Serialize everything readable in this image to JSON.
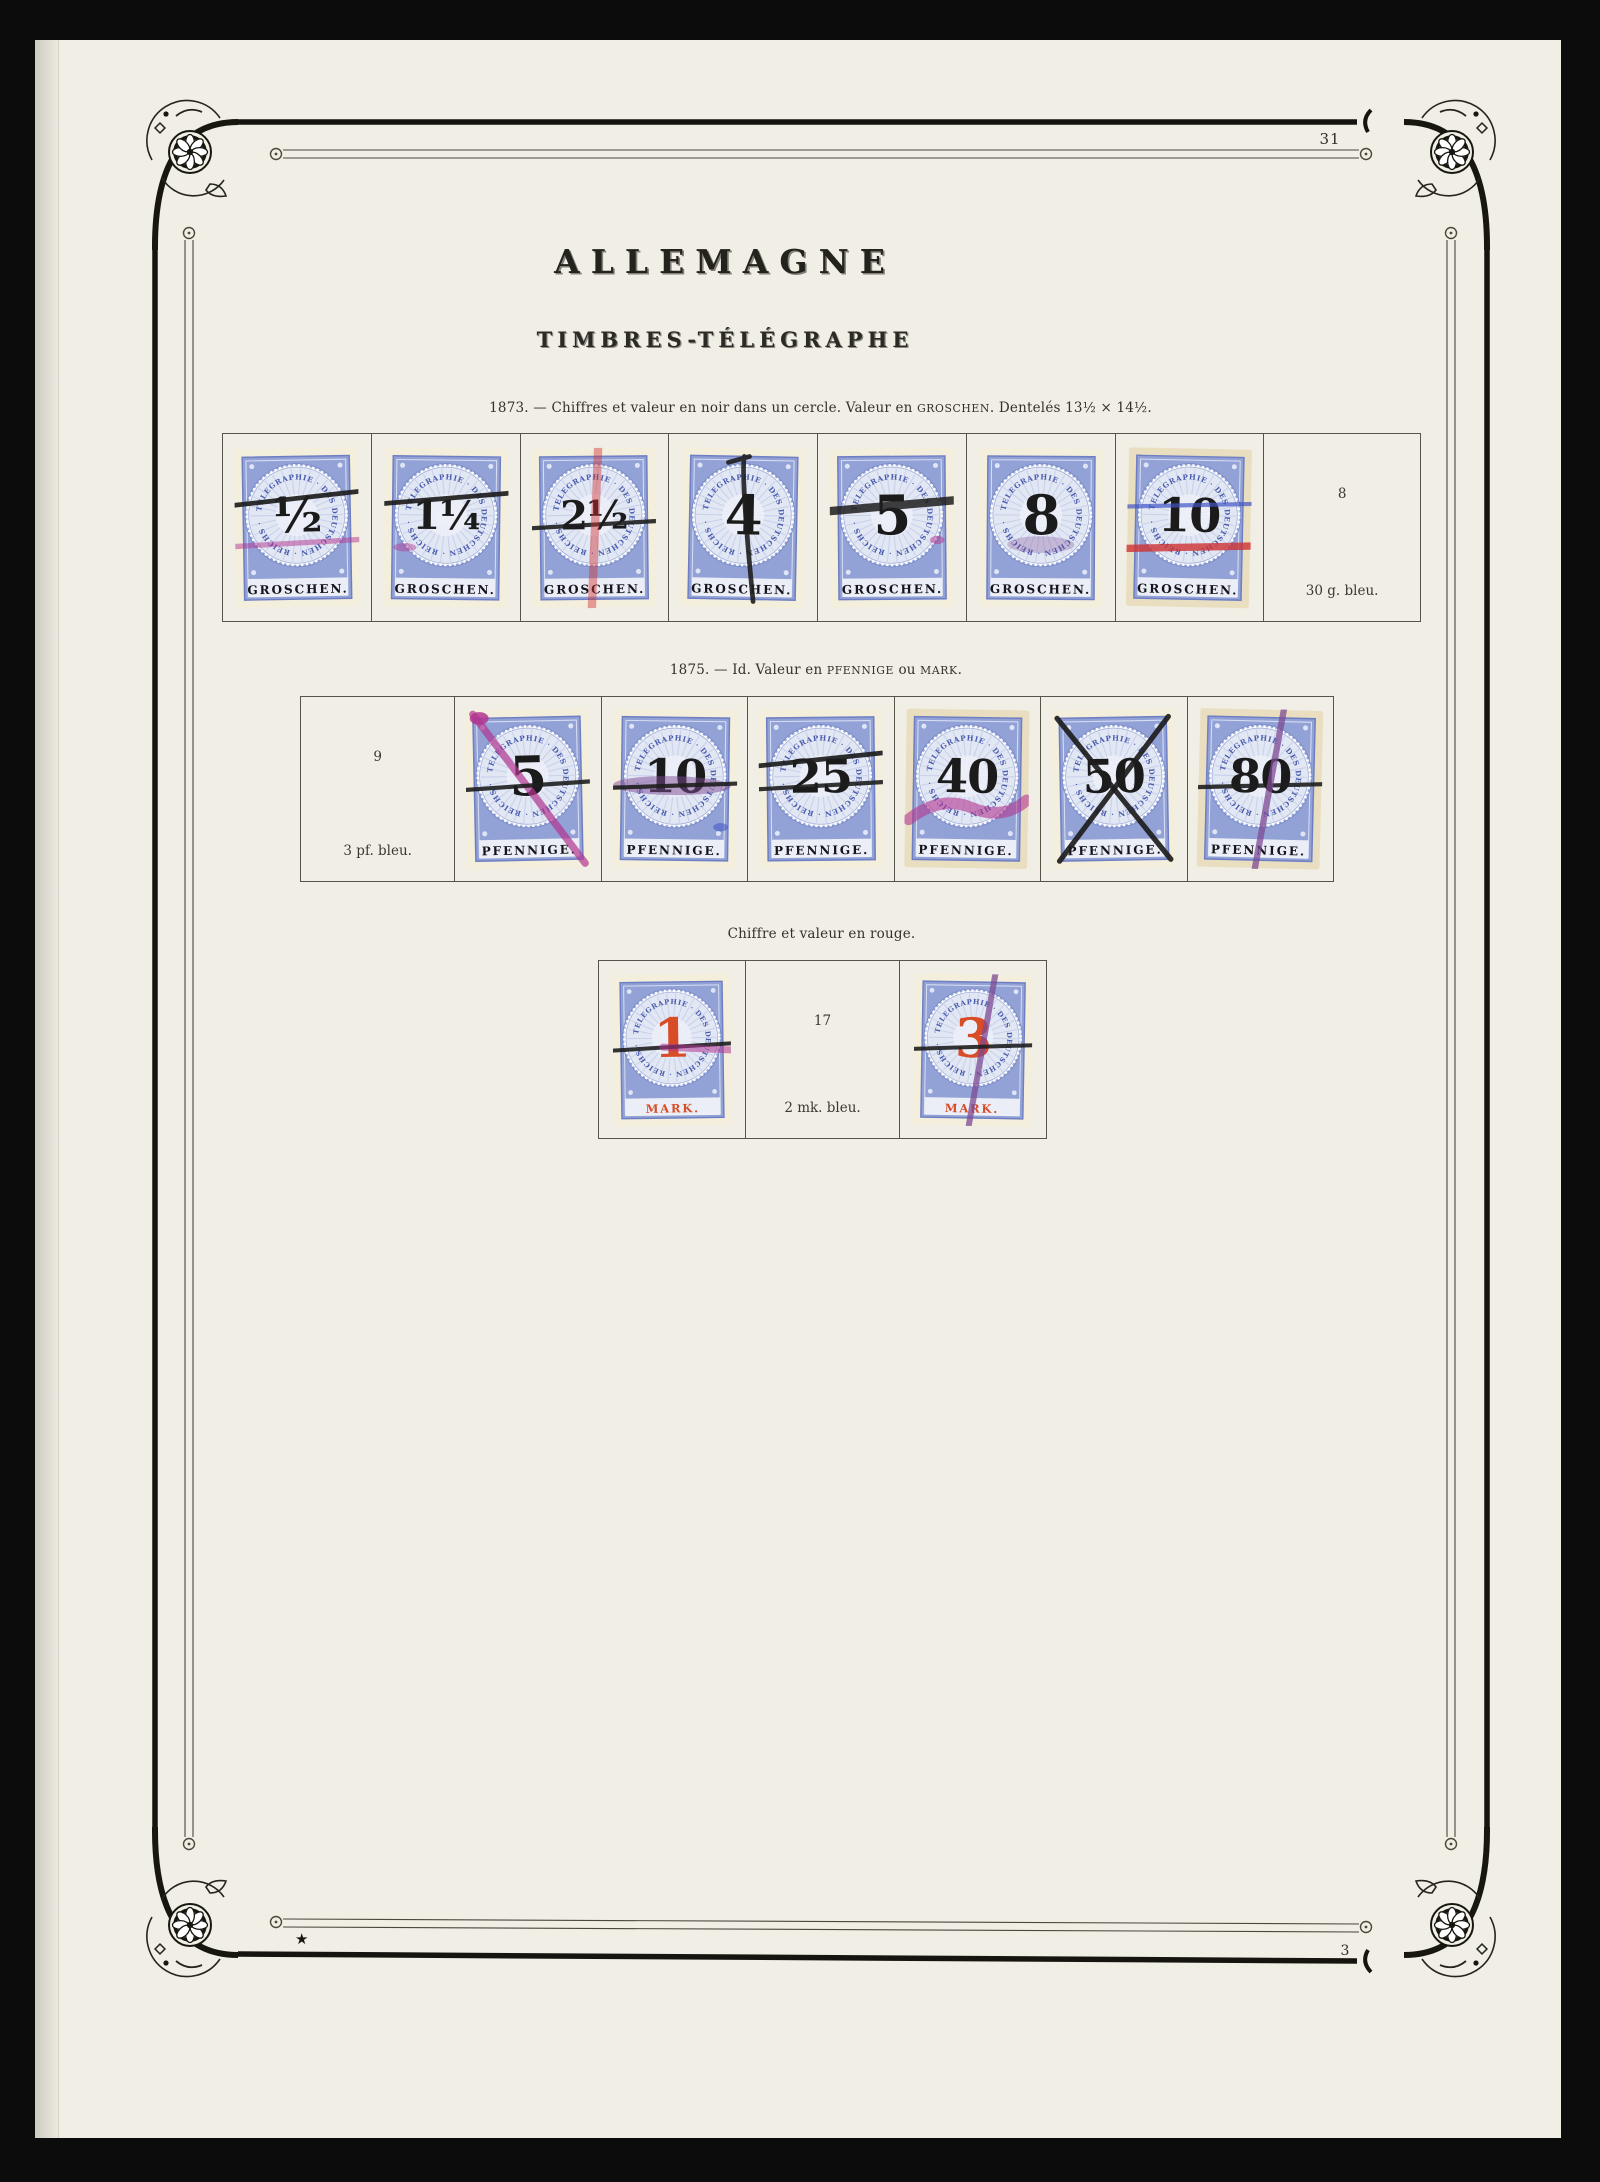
{
  "page": {
    "title": "ALLEMAGNE",
    "subtitle": "TIMBRES-TÉLÉGRAPHE",
    "page_number_top": "31",
    "page_number_bottom": "3",
    "star_mark": "★"
  },
  "stamp_design": {
    "ring_text": "TELEGRAPHIE · DES DEUTSCHEN · REICHS ·",
    "colors": {
      "stamp_blue": "#92a2d6",
      "stamp_blue_dark": "#6d7ec2",
      "stamp_inner_pale": "#e2e7f4",
      "ring_text_blue": "#4a5cae",
      "numeral_black": "#1b1b1b",
      "numeral_red": "#d84c28",
      "paper_cream": "#f4eedc",
      "paper_cream_toned": "#eadec1",
      "cancel_black": "#1e1e1e",
      "cancel_magenta": "#b23590",
      "cancel_red": "#cf3333",
      "cancel_blue": "#4054c4",
      "cancel_purple": "#7c4a93"
    }
  },
  "sections": [
    {
      "caption_parts": [
        {
          "text": "1873. — Chiffres et valeur en noir dans un cercle. Valeur en ",
          "style": ""
        },
        {
          "text": "groschen",
          "style": "sc"
        },
        {
          "text": ". Dentelés 13½ × 14½.",
          "style": ""
        }
      ],
      "unit_label": "GROSCHEN.",
      "numeral_color": "black",
      "cells": [
        {
          "kind": "stamp",
          "value": "½",
          "cancels": [
            "black-h-up",
            "magenta-h-low"
          ]
        },
        {
          "kind": "stamp",
          "value": "1¼",
          "cancels": [
            "black-h-up",
            "pink-dab"
          ]
        },
        {
          "kind": "stamp",
          "value": "2½",
          "cancels": [
            "black-h-mid",
            "red-v"
          ]
        },
        {
          "kind": "stamp",
          "value": "4",
          "cancels": [
            "black-v"
          ]
        },
        {
          "kind": "stamp",
          "value": "5",
          "cancels": [
            "black-thick-h",
            "magenta-dab-right"
          ]
        },
        {
          "kind": "stamp",
          "value": "8",
          "cancels": [
            "purple-smear"
          ]
        },
        {
          "kind": "stamp",
          "value": "10",
          "toned": true,
          "cancels": [
            "blue-h",
            "red-h-low"
          ]
        },
        {
          "kind": "note",
          "number": "8",
          "note": "30 g. bleu."
        }
      ]
    },
    {
      "caption_parts": [
        {
          "text": "1875. — Id. Valeur en ",
          "style": ""
        },
        {
          "text": "pfennige",
          "style": "sc"
        },
        {
          "text": " ou ",
          "style": ""
        },
        {
          "text": "mark",
          "style": "sc"
        },
        {
          "text": ".",
          "style": ""
        }
      ],
      "unit_label": "PFENNIGE.",
      "numeral_color": "black",
      "cells": [
        {
          "kind": "note",
          "number": "9",
          "note": "3 pf. bleu."
        },
        {
          "kind": "stamp",
          "value": "5",
          "cancels": [
            "magenta-diag",
            "black-h-mid",
            "magenta-dab-top"
          ]
        },
        {
          "kind": "stamp",
          "value": "10",
          "cancels": [
            "purple-smear-h",
            "black-h-mid",
            "blue-dab"
          ]
        },
        {
          "kind": "stamp",
          "value": "25",
          "cancels": [
            "black-h-up",
            "black-h-mid"
          ]
        },
        {
          "kind": "stamp",
          "value": "40",
          "toned": true,
          "cancels": [
            "magenta-swoosh"
          ]
        },
        {
          "kind": "stamp",
          "value": "50",
          "cancels": [
            "black-x"
          ]
        },
        {
          "kind": "stamp",
          "value": "80",
          "toned": true,
          "cancels": [
            "black-h-mid",
            "magenta-diag-steep"
          ]
        }
      ]
    },
    {
      "caption_parts": [
        {
          "text": "Chiffre et valeur en rouge.",
          "style": ""
        }
      ],
      "unit_label": "MARK.",
      "numeral_color": "red",
      "cells": [
        {
          "kind": "stamp",
          "value": "1",
          "cancels": [
            "black-h-mid",
            "magenta-h-right"
          ]
        },
        {
          "kind": "note",
          "number": "17",
          "note": "2 mk. bleu."
        },
        {
          "kind": "stamp",
          "value": "3",
          "cancels": [
            "magenta-diag-steep",
            "black-h-mid"
          ]
        }
      ]
    }
  ]
}
